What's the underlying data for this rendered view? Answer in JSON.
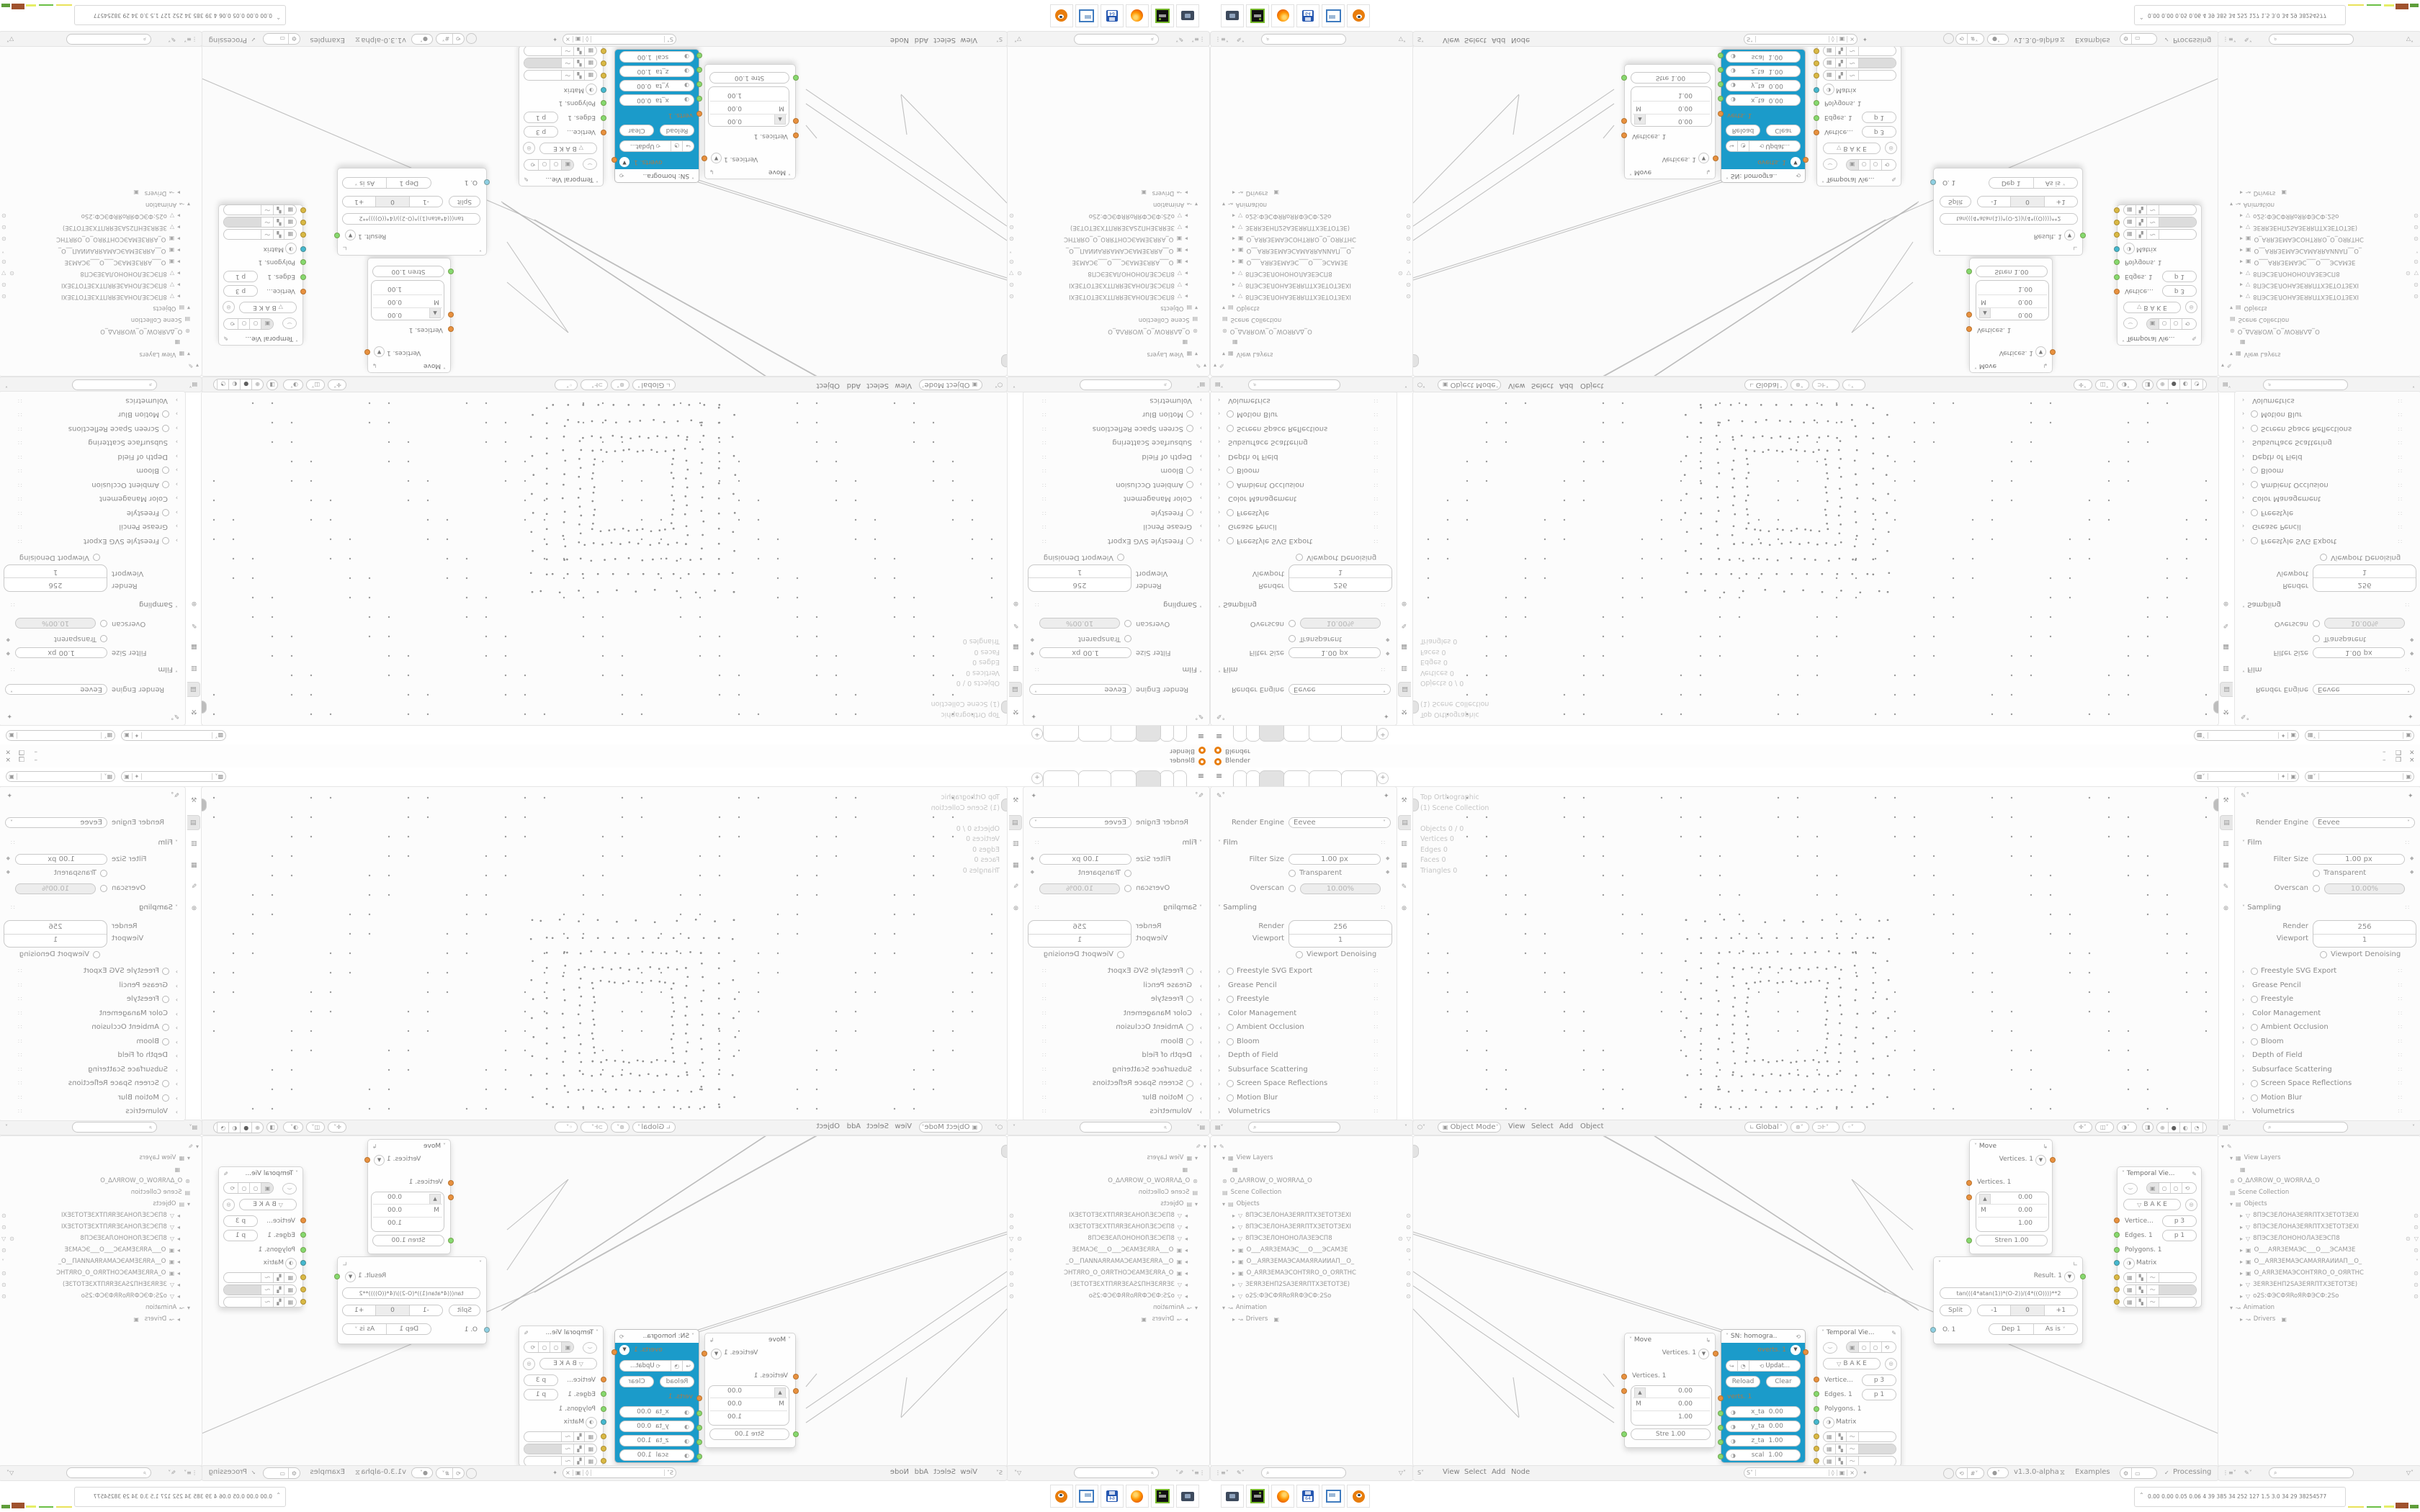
{
  "window": {
    "title": "Blender",
    "minimize": "–",
    "maximize": "❒",
    "close": "×"
  },
  "topbar": {
    "tabs": [
      "",
      "",
      "",
      "",
      "",
      ""
    ],
    "active_tab": 2,
    "new_tab": "+"
  },
  "properties": {
    "render_engine_label": "Render Engine",
    "render_engine_value": "Eevee",
    "film_label": "Film",
    "filter_size_label": "Filter Size",
    "filter_size_value": "1.00 px",
    "transparent_label": "Transparent",
    "overscan_label": "Overscan",
    "overscan_value": "10.00%",
    "sampling_label": "Sampling",
    "render_label": "Render",
    "render_value": "256",
    "viewport_label": "Viewport",
    "viewport_value": "1",
    "denoising_label": "Viewport Denoising",
    "sections": [
      {
        "label": "Freestyle SVG Export",
        "checkbox": true
      },
      {
        "label": "Grease Pencil",
        "checkbox": false
      },
      {
        "label": "Freestyle",
        "checkbox": true
      },
      {
        "label": "Color Management",
        "checkbox": false
      },
      {
        "label": "Ambient Occlusion",
        "checkbox": true
      },
      {
        "label": "Bloom",
        "checkbox": true
      },
      {
        "label": "Depth of Field",
        "checkbox": false
      },
      {
        "label": "Subsurface Scattering",
        "checkbox": false
      },
      {
        "label": "Screen Space Reflections",
        "checkbox": true
      },
      {
        "label": "Motion Blur",
        "checkbox": true
      },
      {
        "label": "Volumetrics",
        "checkbox": false
      }
    ]
  },
  "viewport": {
    "overlay": [
      "Top Orthographic",
      "(1) Scene Collection",
      "",
      "Objects   0 / 0",
      "Vertices   0",
      "Edges   0",
      "Faces   0",
      "Triangles   0"
    ],
    "mode": "Object Mode",
    "menus": [
      "View",
      "Select",
      "Add",
      "Object"
    ],
    "orientation": "Global"
  },
  "outliner": {
    "view_layers": "View Layers",
    "world_name": "O_ΔΛЯROW_O_WOЯRΛΔ_O",
    "scene_collection": "Scene Collection",
    "objects_label": "Objects",
    "objects": [
      {
        "type": "mesh",
        "name": "8ПЭСЗЕЛОНАЗЕЯRПТХЗЕТОТЗЕХI",
        "eye": "open",
        "cam_active": false,
        "extra_icon": false
      },
      {
        "type": "mesh",
        "name": "8ПЭСЗЕЛОНАЗЕЯRПТХЗЕТОТЗЕХI",
        "eye": "open",
        "cam_active": false,
        "extra_icon": false
      },
      {
        "type": "mesh",
        "name": "8ПЭСЗЕЛОНОНОЛАЗЕЭСП8",
        "eye": "open",
        "cam_active": false,
        "extra_icon": true
      },
      {
        "type": "camera",
        "name": "O___AЯRЗЕМАЭС___O___ЭСАМЗЕ",
        "eye": "open",
        "cam_active": false,
        "extra_icon": false
      },
      {
        "type": "camera",
        "name": "O__AЯRЗЕМАЭСАМАЯRАИИАП__O_",
        "eye": "closed",
        "cam_active": false,
        "extra_icon": false
      },
      {
        "type": "camera",
        "name": "O_AЯRЗЕМАЭСОНТЯRО_O_ОЯRТНС",
        "eye": "open",
        "cam_active": false,
        "extra_icon": false
      },
      {
        "type": "mesh",
        "name": "ЗЕЯRЗЕНП2SАЗЕЯRПТХЗЕТОТЗЕ)",
        "eye": "open",
        "cam_active": false,
        "extra_icon": false
      },
      {
        "type": "mesh",
        "name": "o2S:ФЭСФЯRoЯRФЭСФ:2So",
        "eye": "open",
        "cam_active": true,
        "extra_icon": false
      }
    ],
    "animation": "Animation",
    "drivers": "Drivers"
  },
  "node_editor": {
    "menus": [
      "View",
      "Select",
      "Add",
      "Node"
    ],
    "version": "v1.3.0-alpha",
    "examples": "Examples",
    "processing": "Processing",
    "nodes": {
      "move_a": {
        "title": "Move",
        "output": "Vertices. 1",
        "input": "Vertices. 1",
        "axis": "M",
        "v1": "0.00",
        "v2": "0.00",
        "v3": "1.00",
        "strength": "Stre  1.00"
      },
      "move_b": {
        "title": "Move",
        "output": "Vertices. 1",
        "input": "Vertices. 1",
        "axis": "M",
        "v1": "0.00",
        "v2": "0.00",
        "v3": "1.00",
        "strength": "Stren  1.00"
      },
      "sn": {
        "title": "SN: homogra..",
        "output": "overts. 1",
        "update": "Updat...",
        "reload": "Reload",
        "clear": "Clear",
        "input": "verts. 1",
        "f1l": "x_ta",
        "f1v": "0.00",
        "f2l": "y_ta",
        "f2v": "0.00",
        "f3l": "z_ta",
        "f3v": "1.00",
        "f4l": "scal",
        "f4v": "1.00"
      },
      "temporal": {
        "title": "Temporal Vie...",
        "bake": "B A K E",
        "r1l": "Vertice...",
        "r1v": "p  3",
        "r2l": "Edges. 1",
        "r2v": "p  1",
        "r3l": "Polygons. 1",
        "matrix": "Matrix"
      },
      "formula": {
        "result": "Result. 1",
        "expr": "tan(((4*atan(1))*(O-2))/(4*((O))))**2",
        "split": "Split",
        "minus": "-1",
        "zero": "0",
        "plus": "+1",
        "o_label": "O. 1",
        "dep": "Dep  1",
        "mode": "As is"
      }
    }
  },
  "taskbar": {
    "icons": [
      "screenshot-tool",
      "disk-utility",
      "firefox",
      "floppy-64",
      "image-viewer",
      "blender"
    ],
    "stats": "0.00 0.00 0.05 0.06   4     39    385    34    252   127   1.5   3.0    34     29   38254577"
  },
  "colors": {
    "sn_body": "#1b9bca",
    "socket_orange": "#e8913f",
    "socket_green": "#86d96f",
    "socket_blue": "#45b8d0",
    "socket_yellow": "#d9b945",
    "socket_ltblue": "#8ecfe3",
    "wire": "#b3b3b3"
  }
}
